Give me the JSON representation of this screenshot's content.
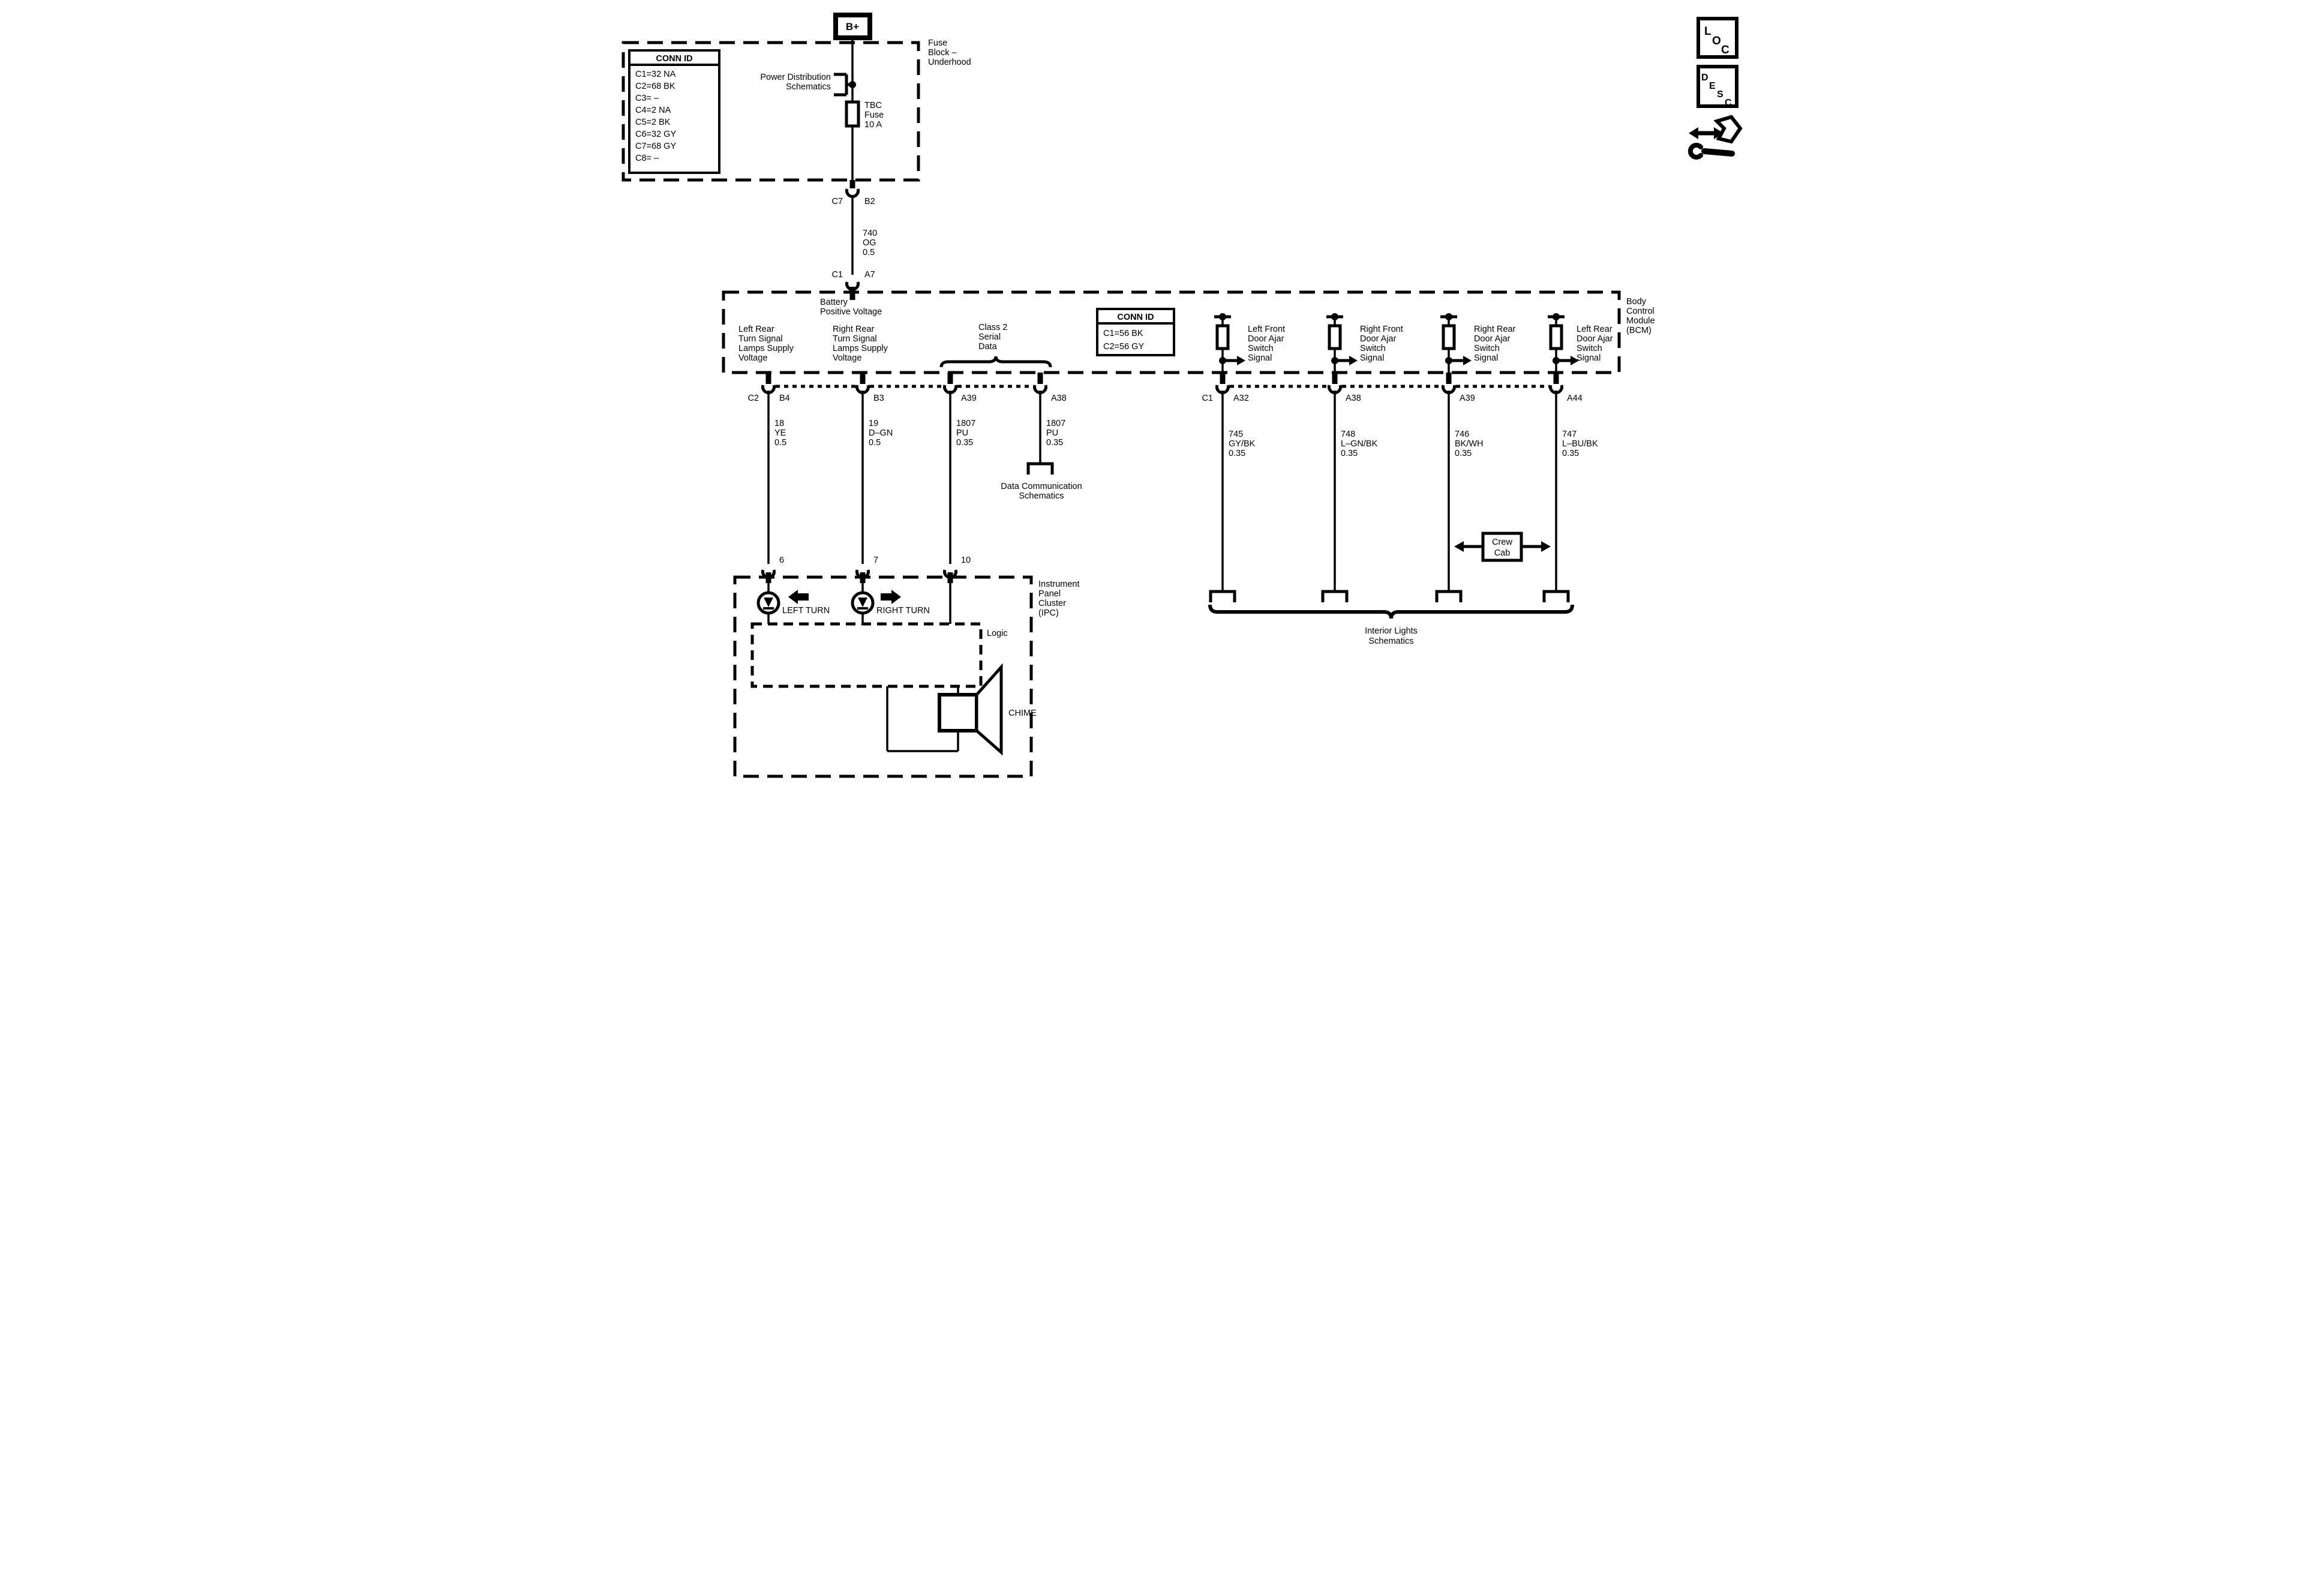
{
  "legend": {
    "loc": [
      "L",
      "O",
      "C"
    ],
    "desc": [
      "D",
      "E",
      "S",
      "C"
    ]
  },
  "fuse_block": {
    "power_terminal": "B+",
    "label": [
      "Fuse",
      "Block –",
      "Underhood"
    ],
    "conn_id": {
      "header": "CONN ID",
      "rows": [
        "C1=32 NA",
        "C2=68 BK",
        "C3= –",
        "C4=2 NA",
        "C5=2 BK",
        "C6=32 GY",
        "C7=68 GY",
        "C8= –"
      ]
    },
    "ref": [
      "Power Distribution",
      "Schematics"
    ],
    "fuse": [
      "TBC",
      "Fuse",
      "10 A"
    ]
  },
  "feed_wire": {
    "top_pin_left": "C7",
    "top_pin_right": "B2",
    "label": [
      "740",
      "OG",
      "0.5"
    ],
    "bottom_pin_left": "C1",
    "bottom_pin_right": "A7"
  },
  "bcm": {
    "label": [
      "Body",
      "Control",
      "Module",
      "(BCM)"
    ],
    "battery": [
      "Battery",
      "Positive Voltage"
    ],
    "outputs": [
      [
        "Left Rear",
        "Turn Signal",
        "Lamps Supply",
        "Voltage"
      ],
      [
        "Right Rear",
        "Turn Signal",
        "Lamps Supply",
        "Voltage"
      ]
    ],
    "class2": [
      "Class 2",
      "Serial",
      "Data"
    ],
    "conn_id": {
      "header": "CONN ID",
      "rows": [
        "C1=56 BK",
        "C2=56 GY"
      ]
    },
    "door_inputs": [
      [
        "Left Front",
        "Door Ajar",
        "Switch",
        "Signal"
      ],
      [
        "Right Front",
        "Door Ajar",
        "Switch",
        "Signal"
      ],
      [
        "Right Rear",
        "Door Ajar",
        "Switch",
        "Signal"
      ],
      [
        "Left Rear",
        "Door Ajar",
        "Switch",
        "Signal"
      ]
    ]
  },
  "pins_left": {
    "conn": "C2",
    "pins": [
      "B4",
      "B3",
      "A39",
      "A38"
    ]
  },
  "pins_right": {
    "conn": "C1",
    "pins": [
      "A32",
      "A38",
      "A39",
      "A44"
    ]
  },
  "wires_left": [
    [
      "18",
      "YE",
      "0.5"
    ],
    [
      "19",
      "D–GN",
      "0.5"
    ],
    [
      "1807",
      "PU",
      "0.35"
    ],
    [
      "1807",
      "PU",
      "0.35"
    ]
  ],
  "wires_right": [
    [
      "745",
      "GY/BK",
      "0.35"
    ],
    [
      "748",
      "L–GN/BK",
      "0.35"
    ],
    [
      "746",
      "BK/WH",
      "0.35"
    ],
    [
      "747",
      "L–BU/BK",
      "0.35"
    ]
  ],
  "refs": {
    "data_comm": [
      "Data Communication",
      "Schematics"
    ],
    "interior": [
      "Interior Lights",
      "Schematics"
    ],
    "crew_cab": [
      "Crew",
      "Cab"
    ]
  },
  "ipc": {
    "label": [
      "Instrument",
      "Panel",
      "Cluster",
      "(IPC)"
    ],
    "pins": [
      "6",
      "7",
      "10"
    ],
    "left_turn": "LEFT TURN",
    "right_turn": "RIGHT TURN",
    "logic": "Logic",
    "chime": "CHIME"
  },
  "colors": {
    "ink": "#000000",
    "background": "#ffffff"
  }
}
